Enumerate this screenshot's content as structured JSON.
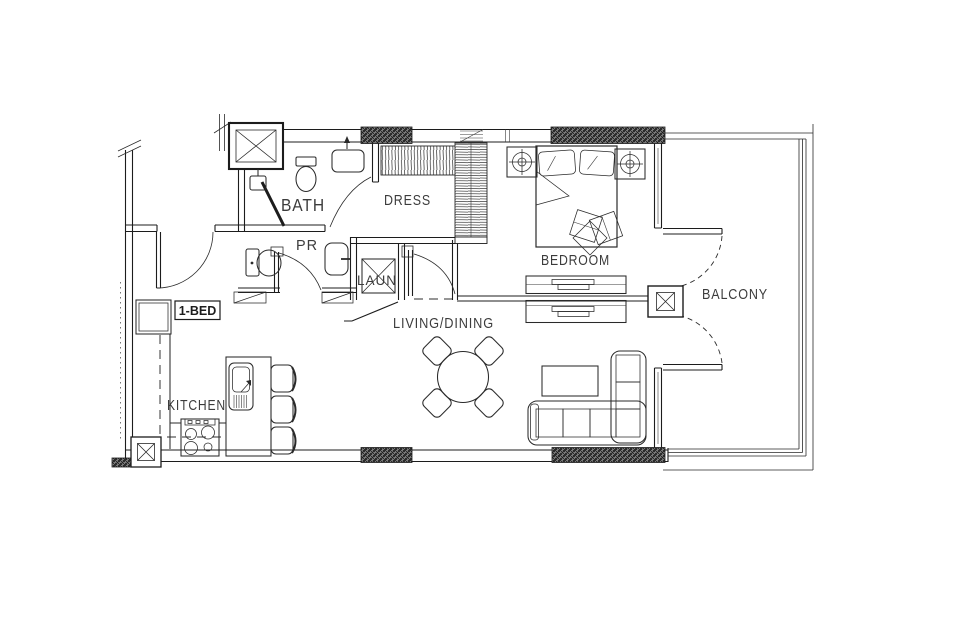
{
  "title": "1-BED apartment floor plan",
  "colors": {
    "background": "#ffffff",
    "ink": "#1c1c1c",
    "label": "#3c3c3c",
    "hatch": "#2e2e2e"
  },
  "unit": {
    "type_label": "1-BED"
  },
  "rooms": {
    "bath": "BATH",
    "dress": "DRESS",
    "powder_room": "PR",
    "laundry": "LAUN",
    "bedroom": "BEDROOM",
    "balcony": "BALCONY",
    "living_dining": "LIVING/DINING",
    "kitchen": "KITCHEN"
  }
}
